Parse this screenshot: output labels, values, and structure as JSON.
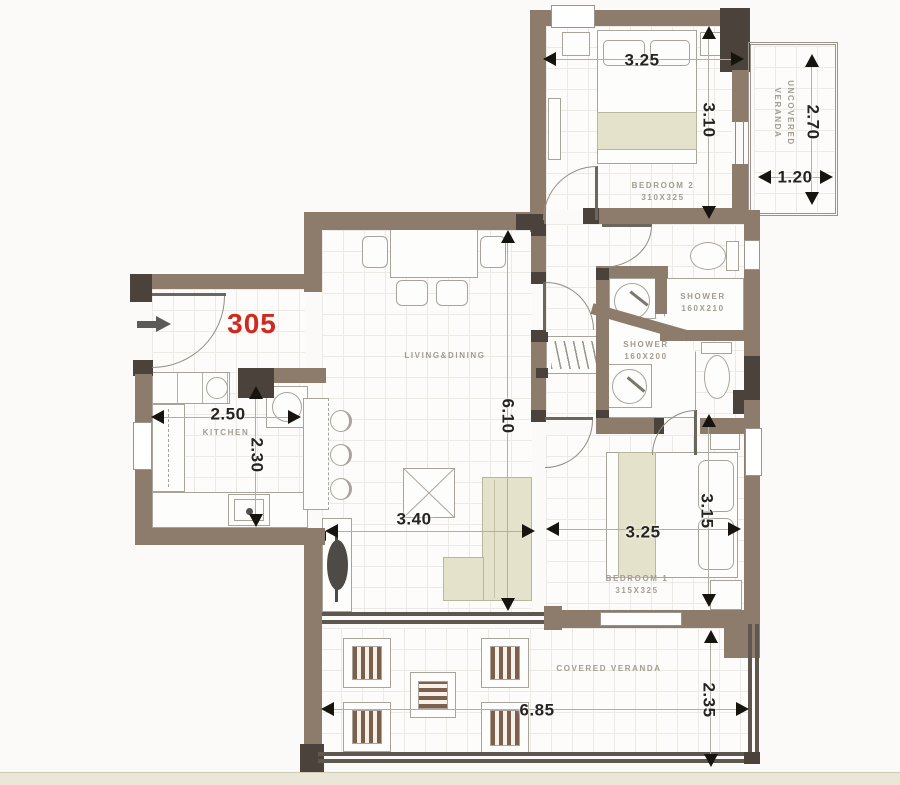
{
  "unit": {
    "number": "305"
  },
  "rooms": {
    "bedroom2": {
      "name": "BEDROOM 2",
      "size": "310X325",
      "dim_w": "3.25",
      "dim_d": "3.10"
    },
    "uncovered_veranda": {
      "line1": "UNCOVERED",
      "line2": "VERANDA",
      "dim_d": "2.70",
      "dim_w": "1.20"
    },
    "shower1": {
      "name": "SHOWER",
      "size": "160X210"
    },
    "shower2": {
      "name": "SHOWER",
      "size": "160X200"
    },
    "living": {
      "name": "LIVING&DINING",
      "dim_l": "6.10",
      "dim_w": "3.40"
    },
    "kitchen": {
      "name": "KITCHEN",
      "dim_w": "2.50",
      "dim_d": "2.30"
    },
    "bedroom1": {
      "name": "BEDROOM 1",
      "size": "315X325",
      "dim_w": "3.25",
      "dim_d": "3.15"
    },
    "covered_veranda": {
      "name": "COVERED VERANDA",
      "dim_w": "6.85",
      "dim_d": "2.35"
    }
  },
  "colors": {
    "wall": "#8d7b6c",
    "wall_dark": "#4a423b",
    "unit_red": "#d02a1e",
    "blanket": "#e4e2ca"
  }
}
